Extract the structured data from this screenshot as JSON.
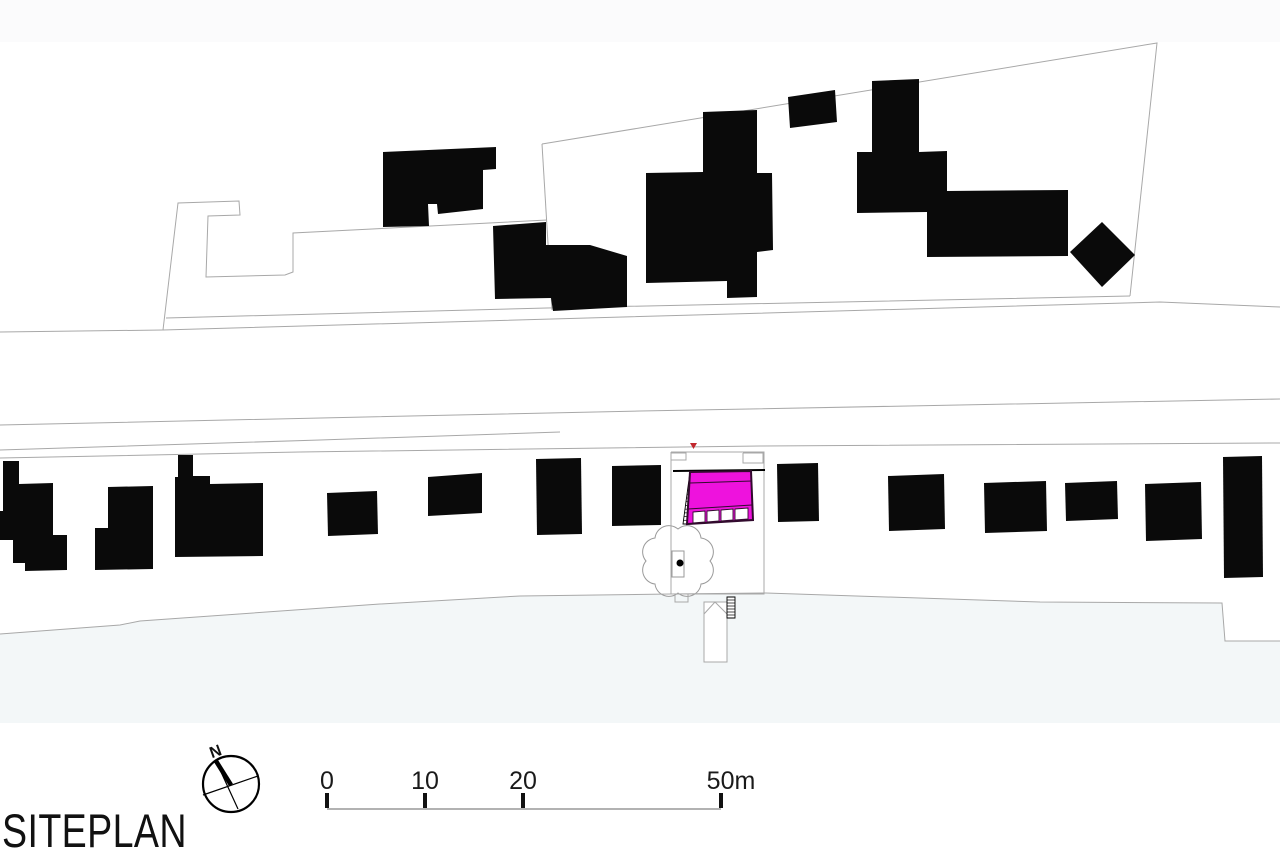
{
  "title": {
    "label": "SITEPLAN"
  },
  "compass": {
    "n_label": "N",
    "cx": 231,
    "cy": 784,
    "r": 28,
    "cross": [
      203,
      795,
      258,
      776
    ],
    "needle": [
      216,
      761,
      238,
      809
    ],
    "needle_thick": [
      216,
      761,
      231,
      785
    ]
  },
  "scale_bar": {
    "ticks": [
      {
        "label": "0",
        "x": 327
      },
      {
        "label": "10",
        "x": 425
      },
      {
        "label": "20",
        "x": 523
      },
      {
        "label": "50m",
        "x": 731
      }
    ],
    "tick_marks": [
      327,
      425,
      523,
      721
    ],
    "label_y": 789,
    "tick_y1": 793,
    "tick_y2": 808,
    "line_y": 809,
    "line_x1": 327,
    "line_x2": 721
  },
  "colors": {
    "background": "#ffffff",
    "top_band": "#fbfbfc",
    "tint": "#f3f7f8",
    "line": "#a8a8a8",
    "building": "#0a0a0a",
    "magenta": "#ee12dd",
    "outline_dark": "#320b2e",
    "red": "#c1272d",
    "text": "#1a1a1a"
  },
  "site": {
    "top_band_rect": {
      "x": 0,
      "y": 0,
      "w": 1280,
      "h": 42
    },
    "tint_polygon": "0,634 120,625 140,621 380,604 520,596 671,594 766,593 1040,602 1222,603 1225,641 1280,641 1280,723 0,723",
    "lines": [
      {
        "name": "parcel-north-outline",
        "points": "163,330 178,203 239,201 240,215 208,216 206,277 285,275 293,272 293,233 547,220"
      },
      {
        "name": "parcel-northeast-outline",
        "points": "542,144 1157,43 1130,296"
      },
      {
        "name": "parcel-division-line",
        "points": "542,144 552,310"
      },
      {
        "name": "road-upper-edge",
        "points": "166,318 547,308 1130,296"
      },
      {
        "name": "road-lower-edge",
        "points": "0,332 163,330 552,319 1160,302 1280,307"
      },
      {
        "name": "street-south-edge-1",
        "points": "0,425 640,411 1280,399"
      },
      {
        "name": "street-south-edge-2",
        "points": "0,450 320,440 560,432"
      },
      {
        "name": "plots-front-line",
        "points": "0,458 300,452 760,446 1280,443"
      },
      {
        "name": "plots-rear-boundary",
        "points": "0,634 120,625 140,621 380,604 520,596 671,594 766,593 1040,602 1222,603 1225,641 1280,641"
      },
      {
        "name": "plot-outline",
        "points": "671,452 764,452 764,594 671,594 671,452"
      },
      {
        "name": "plot-porch-left",
        "points": "671,453 686,453 686,460 671,460 671,453"
      },
      {
        "name": "plot-porch-right",
        "points": "743,453 763,453 763,463 743,463 743,453"
      },
      {
        "name": "plot-step",
        "points": "675,594 688,594 688,602 675,602 675,594"
      }
    ],
    "buildings": [
      {
        "name": "upper-building-1",
        "points": "383,152 496,147 496,169 483,170 483,209 438,214 437,204 428,204 429,226 383,227"
      },
      {
        "name": "upper-building-2",
        "points": "493,226 546,222 546,245 590,245 627,256 627,307 553,311 551,298 495,299"
      },
      {
        "name": "upper-building-3",
        "points": "646,173 703,172 703,112 757,110 757,173 772,173 773,250 757,252 757,297 727,298 727,281 646,283"
      },
      {
        "name": "upper-building-4",
        "points": "788,97 835,90 837,122 790,128"
      },
      {
        "name": "upper-building-5",
        "points": "872,81 919,79 919,152 947,151 947,191 1068,190 1068,256 927,257 927,212 857,213 857,152 872,152"
      },
      {
        "name": "upper-building-diamond",
        "points": "1070,252 1102,222 1135,255 1102,287"
      },
      {
        "name": "lower-building-1",
        "points": "3,461 19,461 19,484 53,483 53,535 67,535 67,570 25,571 25,563 13,563 13,540 0,540 0,511 3,511"
      },
      {
        "name": "lower-building-2",
        "points": "108,487 153,486 153,569 95,570 95,528 108,528"
      },
      {
        "name": "lower-building-3",
        "points": "178,455 193,455 193,476 210,476 210,484 263,483 263,556 175,557 175,477 178,477"
      },
      {
        "name": "lower-building-4",
        "points": "327,493 377,491 378,534 328,536"
      },
      {
        "name": "lower-building-5",
        "points": "428,477 482,473 482,513 428,516"
      },
      {
        "name": "lower-building-6",
        "points": "536,459 581,458 582,534 537,535"
      },
      {
        "name": "lower-building-7",
        "points": "612,466 661,465 661,525 612,526"
      },
      {
        "name": "lower-building-8",
        "points": "777,464 818,463 819,521 778,522"
      },
      {
        "name": "lower-building-9",
        "points": "888,476 944,474 945,529 889,531"
      },
      {
        "name": "lower-building-10",
        "points": "984,483 1046,481 1047,531 985,533"
      },
      {
        "name": "lower-building-11",
        "points": "1065,483 1117,481 1118,519 1066,521"
      },
      {
        "name": "lower-building-12",
        "points": "1145,484 1201,482 1202,539 1146,541"
      },
      {
        "name": "lower-building-13",
        "points": "1223,457 1262,456 1263,577 1224,578"
      }
    ],
    "plot_wall_line": {
      "x1": 673,
      "y1": 471,
      "x2": 765,
      "y2": 470
    },
    "stairs": {
      "tl": [
        690,
        472
      ],
      "tr": [
        697,
        472
      ],
      "bl": [
        683,
        524
      ],
      "br": [
        691,
        524
      ],
      "rungs": 13
    },
    "highlight": {
      "outline": "690,472 751,471 753,520 687,524",
      "divider1": [
        690,
        483,
        752,
        481
      ],
      "divider2": [
        688,
        509,
        752,
        505
      ],
      "windows": [
        "693,512 705,511 705,522 693,523",
        "707,511 719,510 719,521 707,522",
        "721,510 733,509 733,520 721,521",
        "735,509 748,508 748,519 735,520"
      ]
    },
    "marker_triangle": "690,443 697,443 693.5,449",
    "tree": {
      "cloud_path": "M 710 561 A 14 14 0 0 1 701 584 A 14 14 0 0 1 678 593 A 14 14 0 0 1 655 584 A 14 14 0 0 1 646 561 A 14 14 0 0 1 655 538 A 14 14 0 0 1 678 529 A 14 14 0 0 1 701 538 A 14 14 0 0 1 710 561 Z",
      "box": "672,551 684,551 684,577 672,577",
      "dot": {
        "cx": 680,
        "cy": 563,
        "r": 3.5
      }
    },
    "pier": {
      "rect": "704,602 727,602 727,662 704,662",
      "roof": "704,614 715,602 727,614",
      "ladder": {
        "tl": [
          727,
          597
        ],
        "tr": [
          735,
          597
        ],
        "bl": [
          727,
          618
        ],
        "br": [
          735,
          618
        ],
        "rungs": 6
      }
    }
  }
}
